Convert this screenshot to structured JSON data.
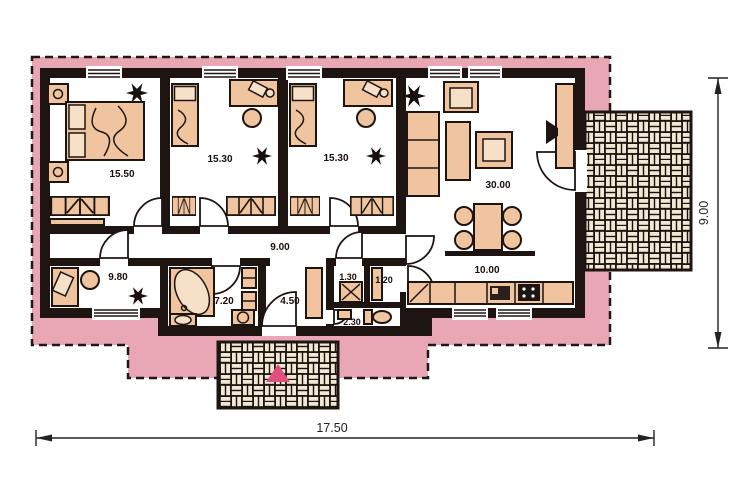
{
  "plan": {
    "rooms": [
      {
        "name": "bedroom-1",
        "area": "15.50"
      },
      {
        "name": "bedroom-2",
        "area": "15.30"
      },
      {
        "name": "bedroom-3",
        "area": "15.30"
      },
      {
        "name": "living-room",
        "area": "30.00"
      },
      {
        "name": "hallway",
        "area": "9.00"
      },
      {
        "name": "study",
        "area": "9.80"
      },
      {
        "name": "bathroom",
        "area": "7.20"
      },
      {
        "name": "entry-hall",
        "area": "4.50"
      },
      {
        "name": "wc",
        "area": "1.30"
      },
      {
        "name": "pantry",
        "area": "1.20"
      },
      {
        "name": "toilet",
        "area": "2.30"
      },
      {
        "name": "dining-kitchen",
        "area": "10.00"
      }
    ],
    "dimensions": {
      "width": "17.50",
      "depth": "9.00"
    },
    "colors": {
      "plot": "#e9a6b4",
      "wall": "#1e1512",
      "furniture": "#efc49e",
      "brick": "#f2e7d3",
      "mortar": "#1a130f",
      "entrance_arrow": "#e0507f"
    }
  }
}
